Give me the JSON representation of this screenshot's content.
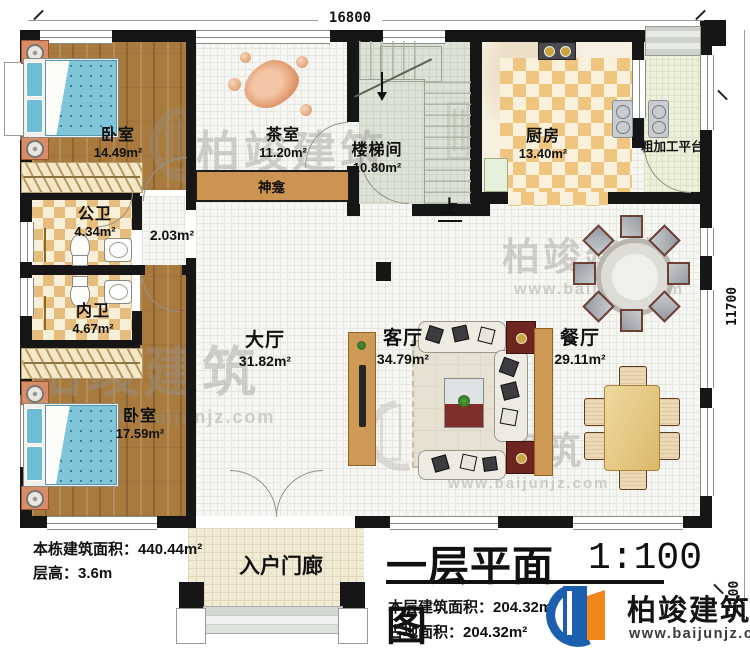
{
  "dimensions": {
    "width_total": "16800",
    "height_total": "11700",
    "porch_depth": "2100"
  },
  "rooms": {
    "bedroom1": {
      "name": "卧室",
      "area": "14.49m²"
    },
    "tea_room": {
      "name": "茶室",
      "area": "11.20m²"
    },
    "stairwell": {
      "name": "楼梯间",
      "area": "10.80m²"
    },
    "kitchen": {
      "name": "厨房",
      "area": "13.40m²"
    },
    "platform": {
      "name": "粗加工平台"
    },
    "shrine": {
      "name": "神龛"
    },
    "corridor": {
      "area": "2.03m²"
    },
    "public_bath": {
      "name": "公卫",
      "area": "4.34m²"
    },
    "private_bath": {
      "name": "内卫",
      "area": "4.67m²"
    },
    "hall": {
      "name": "大厅",
      "area": "31.82m²"
    },
    "living_room": {
      "name": "客厅",
      "area": "34.79m²"
    },
    "dining_room": {
      "name": "餐厅",
      "area": "29.11m²"
    },
    "bedroom2": {
      "name": "卧室",
      "area": "17.59m²"
    },
    "porch": {
      "name": "入户门廊"
    }
  },
  "annotations": {
    "stairs_up": "上"
  },
  "notes": {
    "building_area_label": "本栋建筑面积：",
    "building_area_value": "440.44m²",
    "floor_height_label": "层高：",
    "floor_height_value": "3.6m"
  },
  "title_block": {
    "title": "一层平面图",
    "scale": "1:100",
    "floor_area_label": "本层建筑面积：",
    "floor_area_value": "204.32m²",
    "footprint_label": "占地面积：",
    "footprint_value": "204.32m²"
  },
  "brand": {
    "name": "柏竣建筑",
    "website": "www.baijunjz.com"
  },
  "colors": {
    "wall": "#161616",
    "wood": "#a97a3d",
    "checker": "#e7bd7d",
    "brand_blue": "#1c5fae",
    "brand_orange": "#f08519"
  }
}
